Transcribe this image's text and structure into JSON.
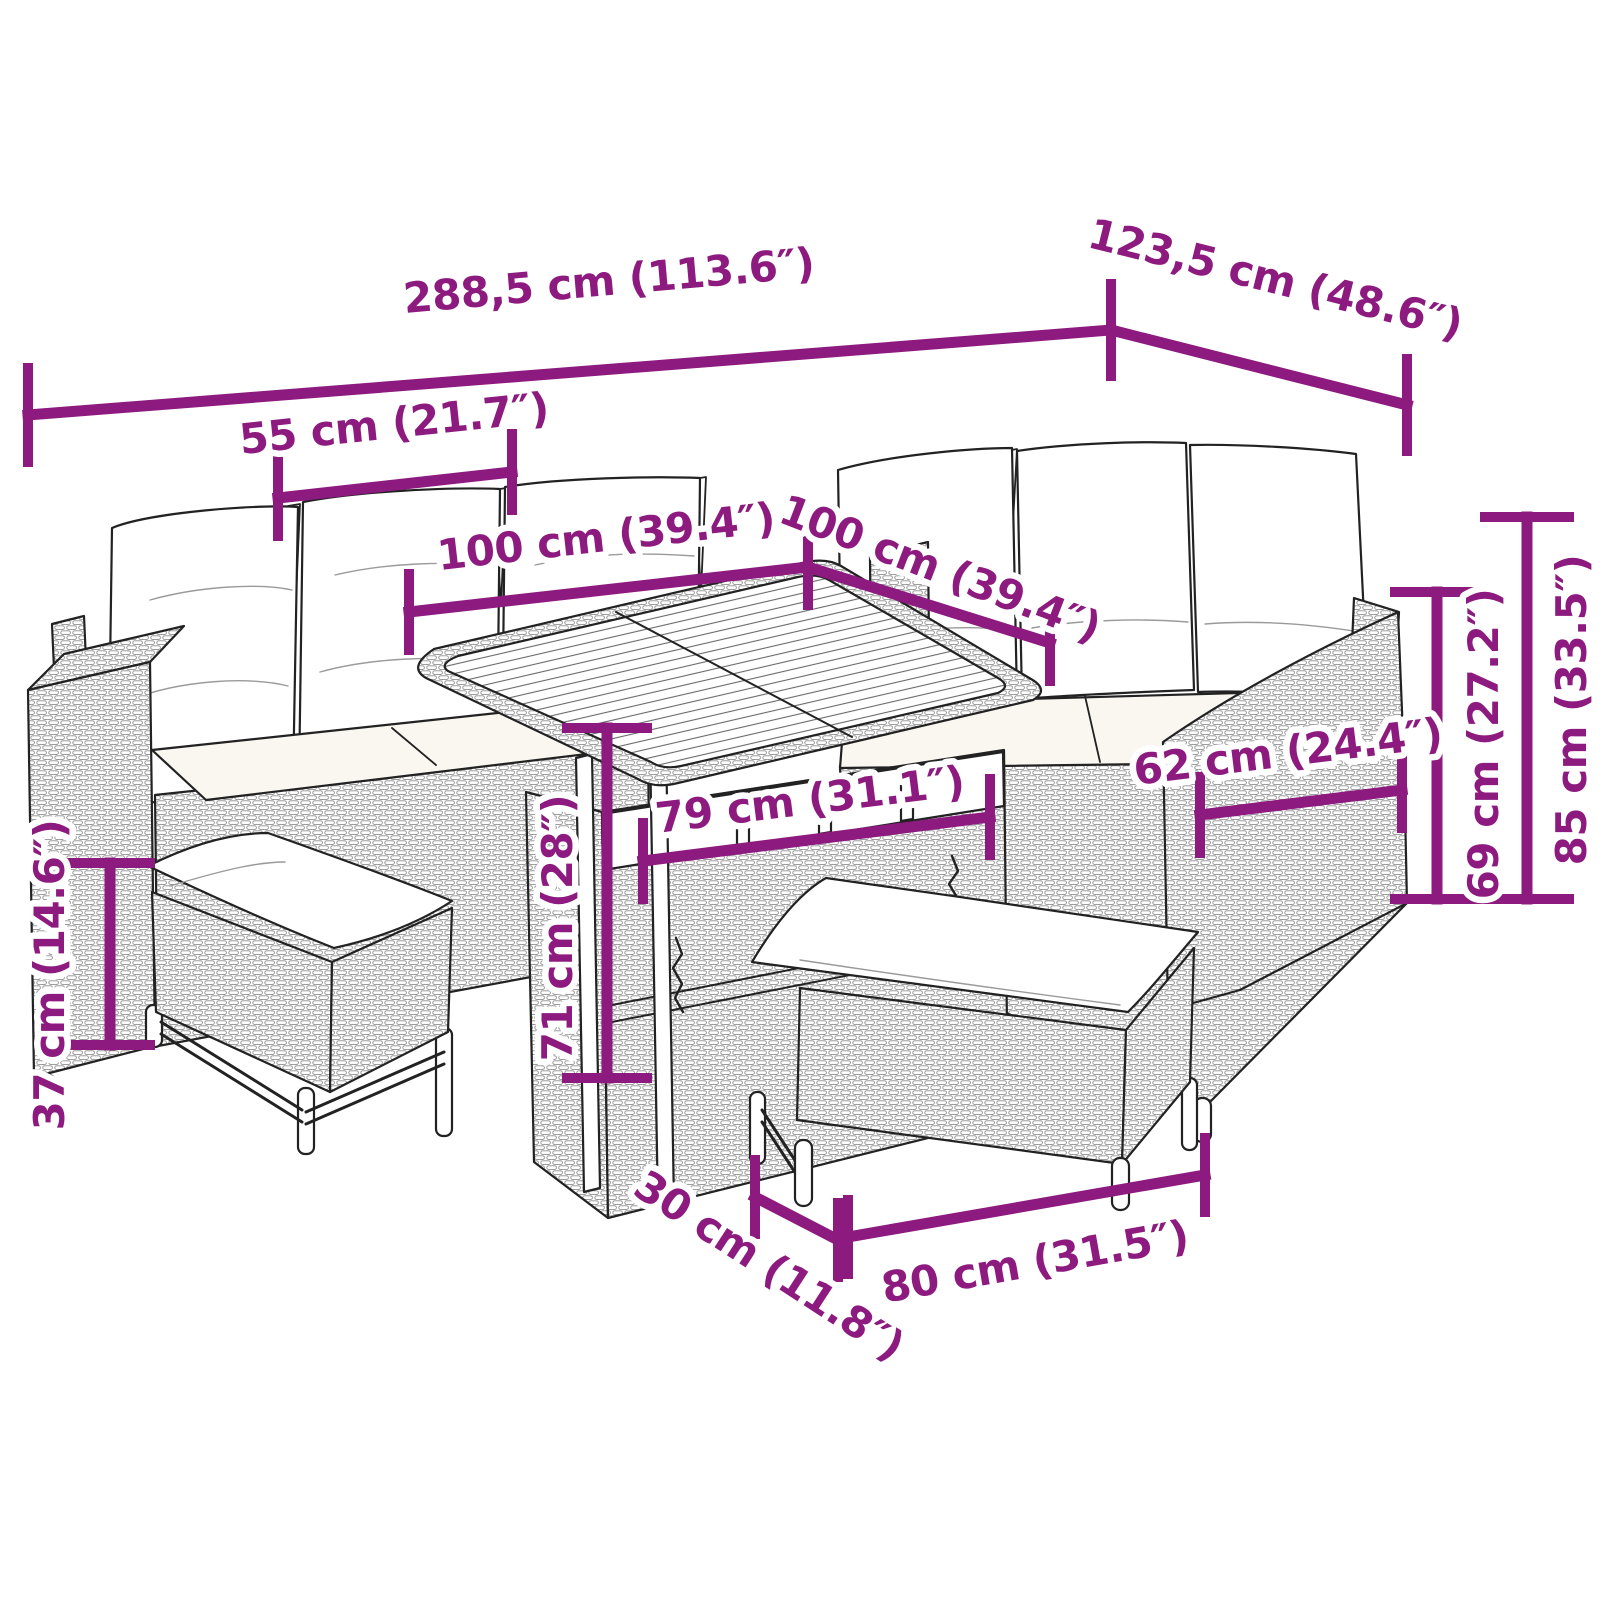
{
  "page": {
    "title": "Poly rattan garden lounge set — dimension diagram"
  },
  "style": {
    "accent": "#8d1a7f",
    "outline": "#222222",
    "halo": "#ffffff",
    "background": "#ffffff",
    "cushion_fill": "#f9f7f0",
    "rattan_stroke": "#8f8f8f"
  },
  "figure": {
    "description": "Black line drawing of an L-shaped poly rattan corner sofa with white cushions, a slatted-top storage table and two cushioned benches"
  },
  "dimensions": {
    "overall_width": {
      "label": "288,5 cm (113.6″)",
      "cm": 288.5,
      "in": 113.6
    },
    "overall_depth": {
      "label": "123,5 cm (48.6″)",
      "cm": 123.5,
      "in": 48.6
    },
    "seat_module_width": {
      "label": "55 cm (21.7″)",
      "cm": 55,
      "in": 21.7
    },
    "table_length": {
      "label": "100 cm (39.4″)",
      "cm": 100,
      "in": 39.4
    },
    "table_width": {
      "label": "100 cm (39.4″)",
      "cm": 100,
      "in": 39.4
    },
    "table_inner_length": {
      "label": "79 cm (31.1″)",
      "cm": 79,
      "in": 31.1
    },
    "table_height": {
      "label": "71 cm (28″)",
      "cm": 71,
      "in": 28
    },
    "bench_height": {
      "label": "37 cm (14.6″)",
      "cm": 37,
      "in": 14.6
    },
    "armrest_depth": {
      "label": "62 cm (24.4″)",
      "cm": 62,
      "in": 24.4
    },
    "backrest_height": {
      "label": "69 cm (27.2″)",
      "cm": 69,
      "in": 27.2
    },
    "total_height": {
      "label": "85 cm (33.5″)",
      "cm": 85,
      "in": 33.5
    },
    "bench_depth": {
      "label": "30 cm (11.8″)",
      "cm": 30,
      "in": 11.8
    },
    "bench_length": {
      "label": "80 cm (31.5″)",
      "cm": 80,
      "in": 31.5
    }
  }
}
